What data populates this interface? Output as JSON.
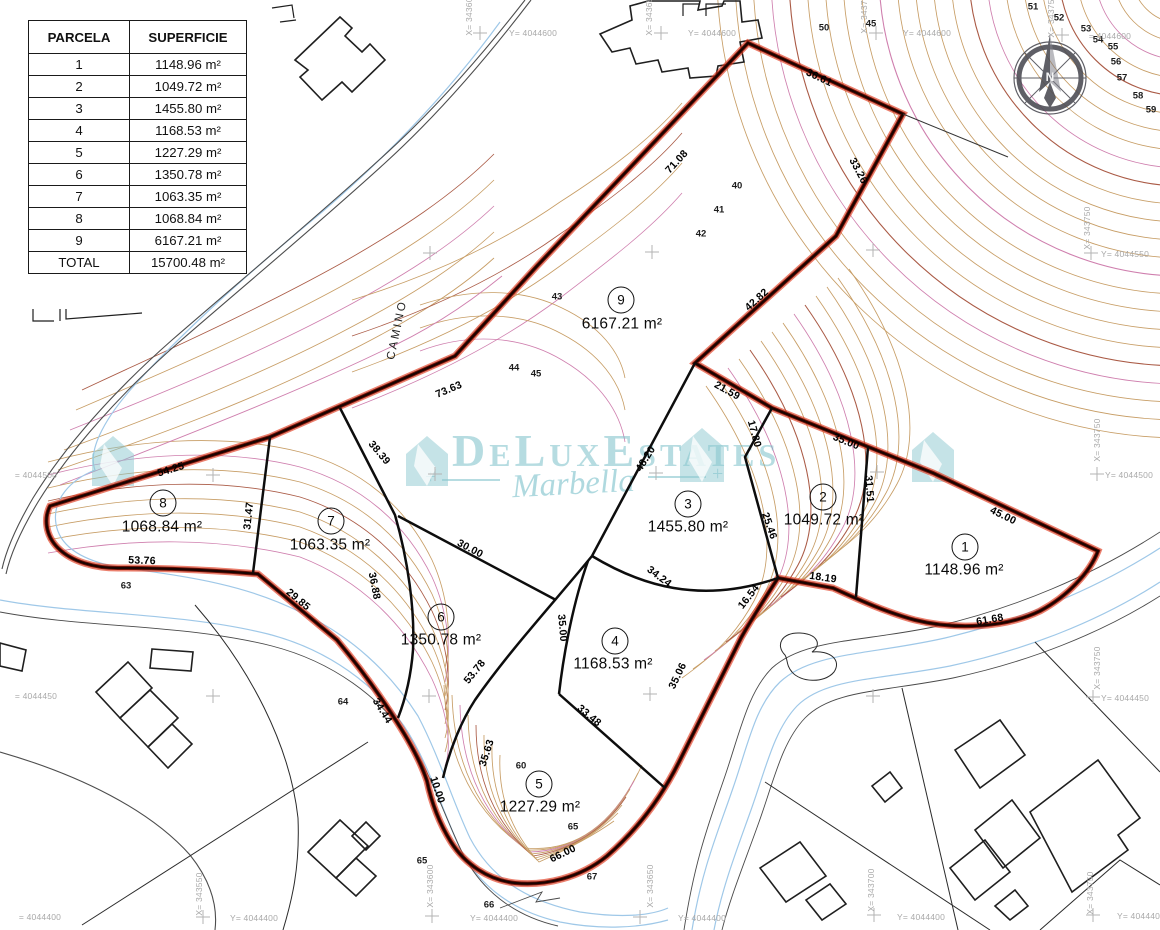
{
  "table": {
    "headers": [
      "PARCELA",
      "SUPERFICIE"
    ],
    "rows": [
      {
        "parcela": "1",
        "superficie": "1148.96 m²"
      },
      {
        "parcela": "2",
        "superficie": "1049.72 m²"
      },
      {
        "parcela": "3",
        "superficie": "1455.80 m²"
      },
      {
        "parcela": "4",
        "superficie": "1168.53 m²"
      },
      {
        "parcela": "5",
        "superficie": "1227.29 m²"
      },
      {
        "parcela": "6",
        "superficie": "1350.78 m²"
      },
      {
        "parcela": "7",
        "superficie": "1063.35 m²"
      },
      {
        "parcela": "8",
        "superficie": "1068.84 m²"
      },
      {
        "parcela": "9",
        "superficie": "6167.21 m²"
      }
    ],
    "total": {
      "parcela": "TOTAL",
      "superficie": "15700.48 m²"
    }
  },
  "parcels": [
    {
      "num": "1",
      "area": "1148.96 m²",
      "nx": 965,
      "ny": 547,
      "ax": 964,
      "ay": 570
    },
    {
      "num": "2",
      "area": "1049.72 m²",
      "nx": 823,
      "ny": 497,
      "ax": 824,
      "ay": 520
    },
    {
      "num": "3",
      "area": "1455.80 m²",
      "nx": 688,
      "ny": 504,
      "ax": 688,
      "ay": 527
    },
    {
      "num": "4",
      "area": "1168.53 m²",
      "nx": 615,
      "ny": 641,
      "ax": 613,
      "ay": 664
    },
    {
      "num": "5",
      "area": "1227.29 m²",
      "nx": 539,
      "ny": 784,
      "ax": 540,
      "ay": 807
    },
    {
      "num": "6",
      "area": "1350.78 m²",
      "nx": 441,
      "ny": 617,
      "ax": 441,
      "ay": 640
    },
    {
      "num": "7",
      "area": "1063.35 m²",
      "nx": 331,
      "ny": 521,
      "ax": 330,
      "ay": 545
    },
    {
      "num": "8",
      "area": "1068.84 m²",
      "nx": 163,
      "ny": 503,
      "ax": 162,
      "ay": 527
    },
    {
      "num": "9",
      "area": "6167.21 m²",
      "nx": 621,
      "ny": 300,
      "ax": 622,
      "ay": 324
    }
  ],
  "dimensions": [
    {
      "t": "71.08",
      "x": 677,
      "y": 162,
      "r": -47
    },
    {
      "t": "36.61",
      "x": 819,
      "y": 78,
      "r": 25
    },
    {
      "t": "33.26",
      "x": 858,
      "y": 171,
      "r": 62
    },
    {
      "t": "42.82",
      "x": 757,
      "y": 300,
      "r": -42
    },
    {
      "t": "21.59",
      "x": 727,
      "y": 391,
      "r": 29
    },
    {
      "t": "35.00",
      "x": 846,
      "y": 442,
      "r": 22
    },
    {
      "t": "45.00",
      "x": 1003,
      "y": 516,
      "r": 26
    },
    {
      "t": "61.68",
      "x": 990,
      "y": 620,
      "r": -10
    },
    {
      "t": "18.19",
      "x": 823,
      "y": 578,
      "r": 8
    },
    {
      "t": "16.54",
      "x": 749,
      "y": 597,
      "r": -52
    },
    {
      "t": "35.06",
      "x": 678,
      "y": 676,
      "r": -64
    },
    {
      "t": "66.00",
      "x": 563,
      "y": 854,
      "r": -26
    },
    {
      "t": "10.00",
      "x": 437,
      "y": 790,
      "r": 72
    },
    {
      "t": "34.44",
      "x": 382,
      "y": 711,
      "r": 58
    },
    {
      "t": "29.85",
      "x": 298,
      "y": 600,
      "r": 40
    },
    {
      "t": "53.76",
      "x": 142,
      "y": 561,
      "r": 2
    },
    {
      "t": "54.25",
      "x": 171,
      "y": 470,
      "r": -17
    },
    {
      "t": "73.63",
      "x": 449,
      "y": 390,
      "r": -23
    },
    {
      "t": "31.47",
      "x": 249,
      "y": 516,
      "r": -84
    },
    {
      "t": "38.39",
      "x": 379,
      "y": 453,
      "r": 50
    },
    {
      "t": "36.88",
      "x": 374,
      "y": 586,
      "r": 79
    },
    {
      "t": "30.00",
      "x": 470,
      "y": 549,
      "r": 28
    },
    {
      "t": "53.78",
      "x": 475,
      "y": 672,
      "r": -51
    },
    {
      "t": "35.63",
      "x": 487,
      "y": 753,
      "r": -72
    },
    {
      "t": "35.00",
      "x": 562,
      "y": 628,
      "r": 85
    },
    {
      "t": "33.48",
      "x": 589,
      "y": 716,
      "r": 40
    },
    {
      "t": "34.24",
      "x": 659,
      "y": 577,
      "r": 37
    },
    {
      "t": "48.20",
      "x": 646,
      "y": 459,
      "r": -58
    },
    {
      "t": "17.80",
      "x": 754,
      "y": 434,
      "r": 75
    },
    {
      "t": "25.46",
      "x": 769,
      "y": 526,
      "r": 71
    },
    {
      "t": "31.51",
      "x": 869,
      "y": 489,
      "r": 86
    }
  ],
  "contour_labels": [
    {
      "t": "40",
      "x": 737,
      "y": 186
    },
    {
      "t": "41",
      "x": 719,
      "y": 210
    },
    {
      "t": "42",
      "x": 701,
      "y": 234
    },
    {
      "t": "43",
      "x": 557,
      "y": 297
    },
    {
      "t": "44",
      "x": 514,
      "y": 368
    },
    {
      "t": "45",
      "x": 536,
      "y": 374
    },
    {
      "t": "45",
      "x": 871,
      "y": 24
    },
    {
      "t": "50",
      "x": 824,
      "y": 28
    },
    {
      "t": "51",
      "x": 1033,
      "y": 7
    },
    {
      "t": "52",
      "x": 1059,
      "y": 18
    },
    {
      "t": "53",
      "x": 1086,
      "y": 29
    },
    {
      "t": "54",
      "x": 1098,
      "y": 40
    },
    {
      "t": "55",
      "x": 1113,
      "y": 47
    },
    {
      "t": "56",
      "x": 1116,
      "y": 62
    },
    {
      "t": "57",
      "x": 1122,
      "y": 78
    },
    {
      "t": "58",
      "x": 1138,
      "y": 96
    },
    {
      "t": "59",
      "x": 1151,
      "y": 110
    },
    {
      "t": "60",
      "x": 521,
      "y": 766
    },
    {
      "t": "63",
      "x": 126,
      "y": 586
    },
    {
      "t": "64",
      "x": 343,
      "y": 702
    },
    {
      "t": "65",
      "x": 573,
      "y": 827
    },
    {
      "t": "65",
      "x": 422,
      "y": 861
    },
    {
      "t": "66",
      "x": 489,
      "y": 905
    },
    {
      "t": "67",
      "x": 592,
      "y": 877
    }
  ],
  "coord_labels": [
    {
      "t": "Y= 4044600",
      "x": 533,
      "y": 33,
      "r": 0
    },
    {
      "t": "Y= 4044600",
      "x": 712,
      "y": 33,
      "r": 0
    },
    {
      "t": "Y= 4044600",
      "x": 927,
      "y": 33,
      "r": 0
    },
    {
      "t": "= 4044600",
      "x": 1110,
      "y": 36,
      "r": 0
    },
    {
      "t": "X= 343600",
      "x": 469,
      "y": 14,
      "r": -90
    },
    {
      "t": "X= 343650",
      "x": 649,
      "y": 14,
      "r": -90
    },
    {
      "t": "X= 343700",
      "x": 864,
      "y": 12,
      "r": -90
    },
    {
      "t": "X= 343750",
      "x": 1051,
      "y": 16,
      "r": -90
    },
    {
      "t": "= 4044500",
      "x": 36,
      "y": 475,
      "r": 0
    },
    {
      "t": "= 4044450",
      "x": 36,
      "y": 696,
      "r": 0
    },
    {
      "t": "= 4044400",
      "x": 40,
      "y": 917,
      "r": 0
    },
    {
      "t": "Y= 4044550",
      "x": 1125,
      "y": 254,
      "r": 0
    },
    {
      "t": "Y= 4044500",
      "x": 1129,
      "y": 475,
      "r": 0
    },
    {
      "t": "Y= 4044450",
      "x": 1125,
      "y": 698,
      "r": 0
    },
    {
      "t": "X= 343750",
      "x": 1087,
      "y": 228,
      "r": -90
    },
    {
      "t": "X= 343750",
      "x": 1097,
      "y": 440,
      "r": -90
    },
    {
      "t": "X= 343750",
      "x": 1097,
      "y": 668,
      "r": -90
    },
    {
      "t": "Y= 4044400",
      "x": 254,
      "y": 918,
      "r": 0
    },
    {
      "t": "Y= 4044400",
      "x": 494,
      "y": 918,
      "r": 0
    },
    {
      "t": "Y= 4044400",
      "x": 702,
      "y": 918,
      "r": 0
    },
    {
      "t": "Y= 4044400",
      "x": 921,
      "y": 917,
      "r": 0
    },
    {
      "t": "Y= 4044400",
      "x": 1141,
      "y": 916,
      "r": 0
    },
    {
      "t": "X= 343550",
      "x": 199,
      "y": 894,
      "r": -90
    },
    {
      "t": "X= 343600",
      "x": 430,
      "y": 886,
      "r": -90
    },
    {
      "t": "X= 343650",
      "x": 650,
      "y": 886,
      "r": -90
    },
    {
      "t": "X= 343700",
      "x": 871,
      "y": 890,
      "r": -90
    },
    {
      "t": "X= 343750",
      "x": 1090,
      "y": 893,
      "r": -90
    }
  ],
  "crosses": [
    [
      480,
      33
    ],
    [
      661,
      33
    ],
    [
      876,
      33
    ],
    [
      1062,
      35
    ],
    [
      430,
      253
    ],
    [
      652,
      252
    ],
    [
      873,
      250
    ],
    [
      1091,
      253
    ],
    [
      213,
      475
    ],
    [
      435,
      474
    ],
    [
      656,
      473
    ],
    [
      877,
      472
    ],
    [
      1097,
      474
    ],
    [
      213,
      696
    ],
    [
      429,
      696
    ],
    [
      650,
      694
    ],
    [
      873,
      696
    ],
    [
      1093,
      697
    ],
    [
      203,
      917
    ],
    [
      432,
      916
    ],
    [
      640,
      917
    ],
    [
      874,
      915
    ],
    [
      1093,
      915
    ]
  ],
  "camino": {
    "t": "CAMINO",
    "x": 398,
    "y": 330,
    "r": -78
  },
  "watermark": {
    "brand": "DeLuxEstates",
    "sub": "Marbella"
  },
  "compass": {
    "n": "N"
  },
  "colors": {
    "boundary_halo": "#e03c20",
    "boundary_core": "#1a0300",
    "contour_tan": "#c79d65",
    "contour_pink": "#cf7fae",
    "contour_red": "#aa5a45",
    "stream_blue": "#9fc8e8",
    "watermark_teal": "rgba(110,186,196,0.5)"
  }
}
